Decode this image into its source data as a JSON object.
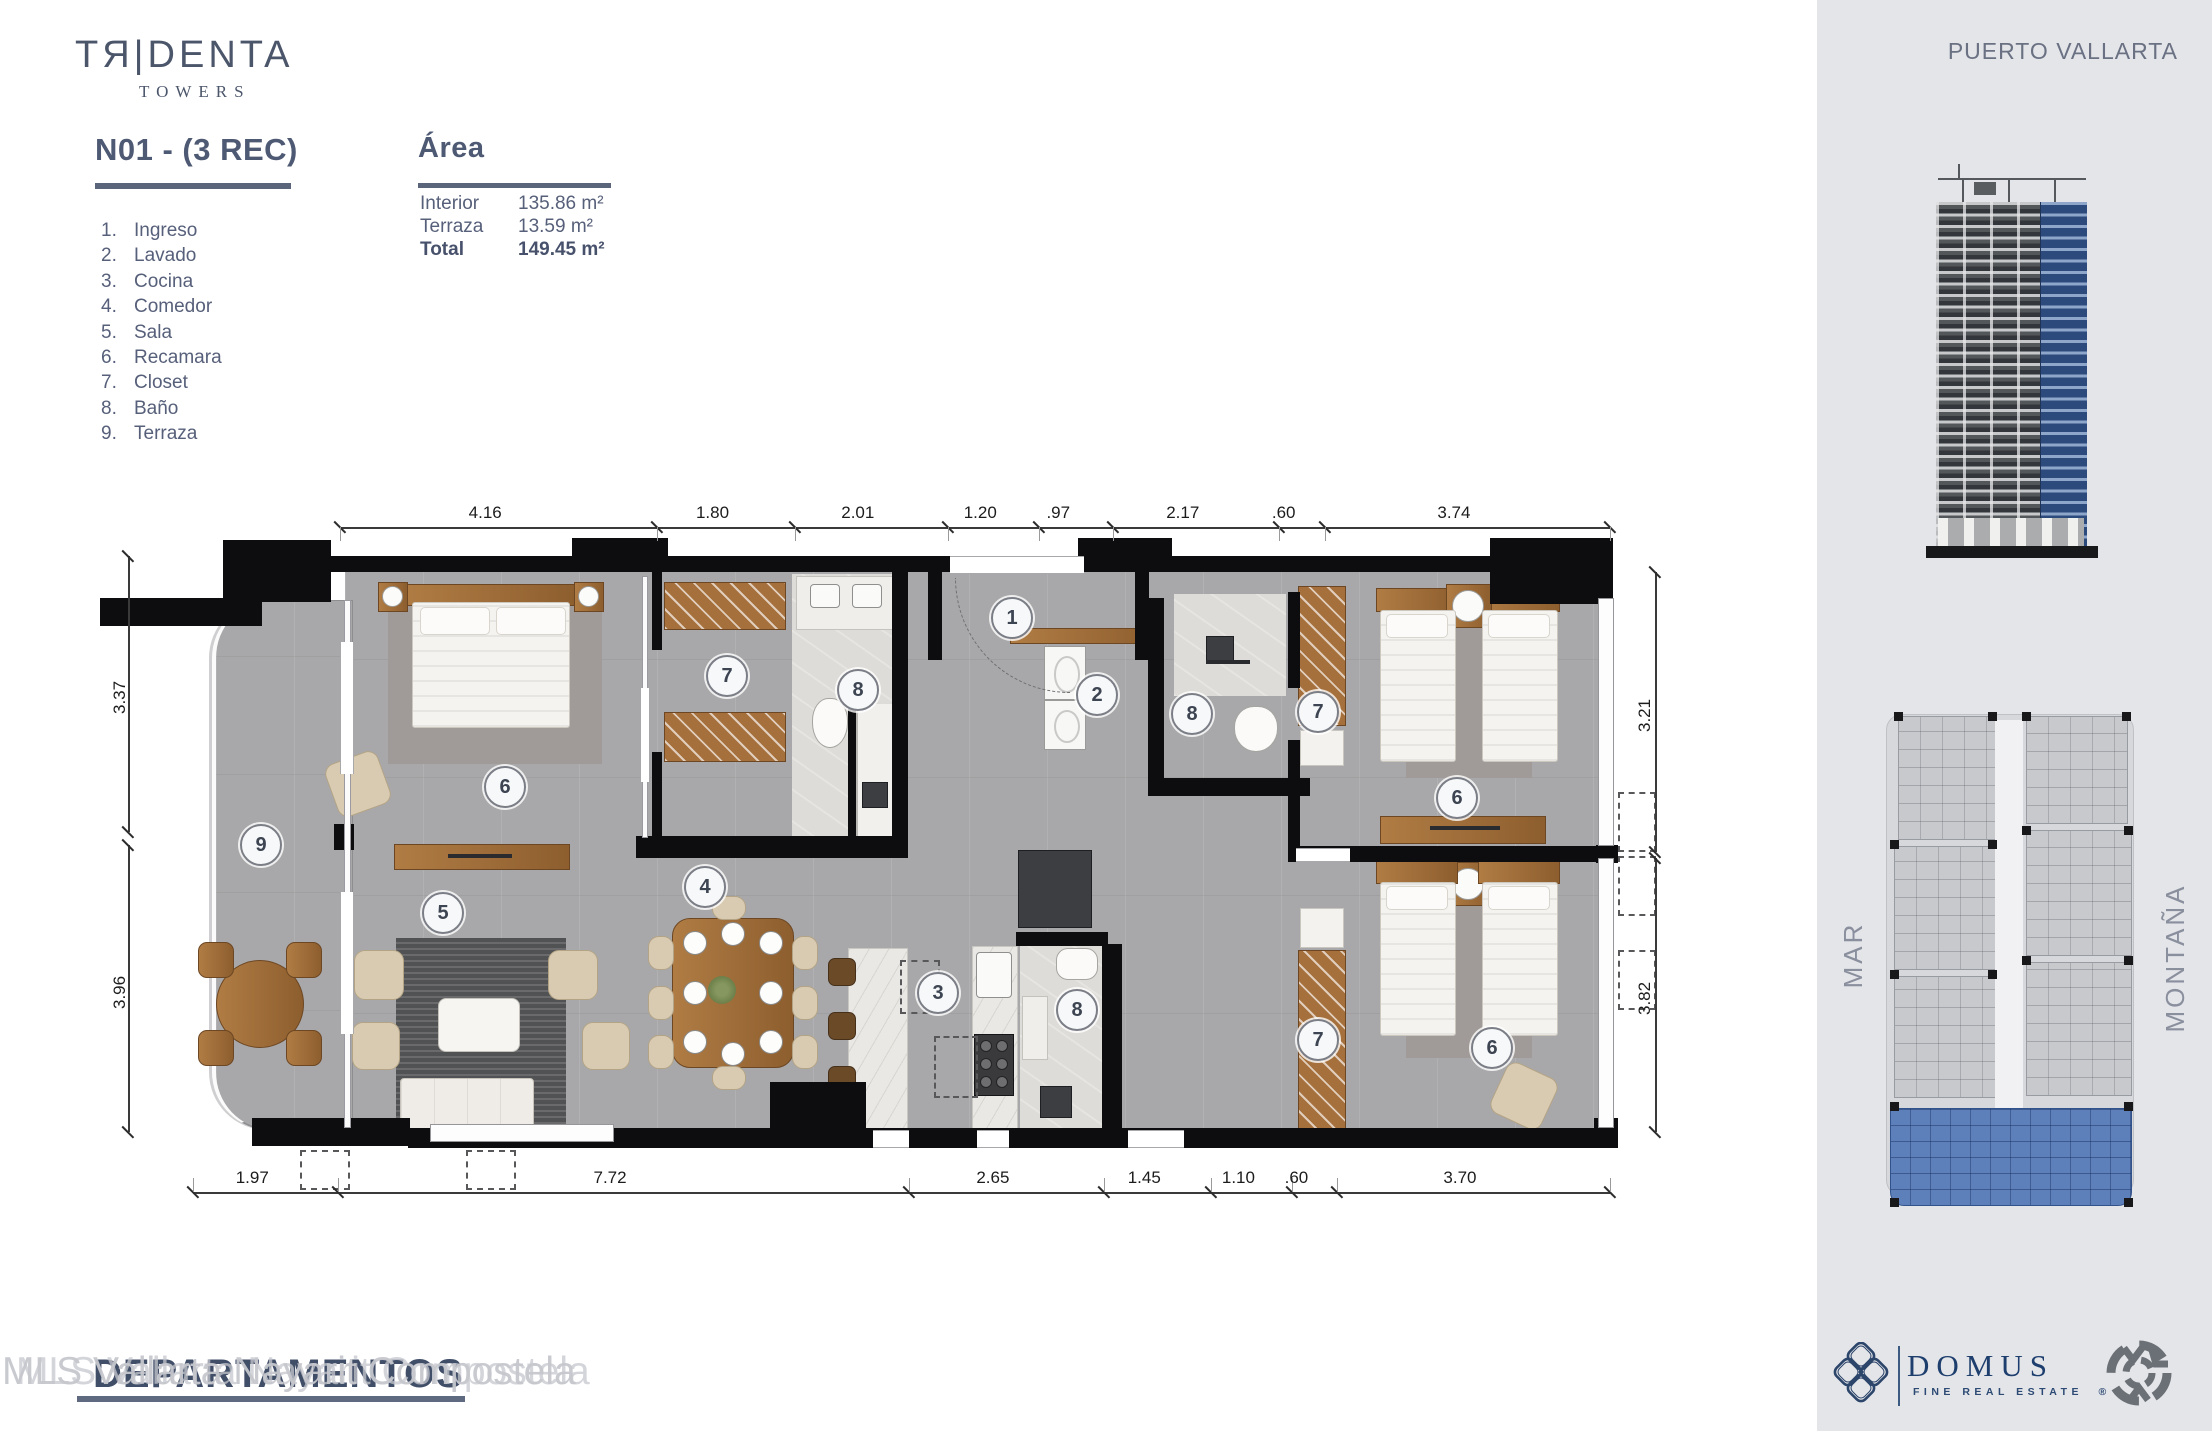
{
  "brand": {
    "logo_main": "TЯ|DENTA",
    "logo_sub": "TOWERS"
  },
  "unit": {
    "title": "N01 - (3 REC)"
  },
  "legend": {
    "items": [
      {
        "n": "1.",
        "label": "Ingreso"
      },
      {
        "n": "2.",
        "label": "Lavado"
      },
      {
        "n": "3.",
        "label": "Cocina"
      },
      {
        "n": "4.",
        "label": "Comedor"
      },
      {
        "n": "5.",
        "label": "Sala"
      },
      {
        "n": "6.",
        "label": "Recamara"
      },
      {
        "n": "7.",
        "label": "Closet"
      },
      {
        "n": "8.",
        "label": "Baño"
      },
      {
        "n": "9.",
        "label": "Terraza"
      }
    ]
  },
  "area": {
    "title": "Área",
    "rows": [
      {
        "label": "Interior",
        "value": "135.86 m²",
        "bold": false
      },
      {
        "label": "Terraza",
        "value": "13.59 m²",
        "bold": false
      },
      {
        "label": "Total",
        "value": "149.45 m²",
        "bold": true
      }
    ]
  },
  "floorplan": {
    "badges": [
      {
        "n": "9",
        "x": 261,
        "y": 845
      },
      {
        "n": "6",
        "x": 505,
        "y": 787
      },
      {
        "n": "5",
        "x": 443,
        "y": 913
      },
      {
        "n": "4",
        "x": 705,
        "y": 887
      },
      {
        "n": "7",
        "x": 727,
        "y": 676
      },
      {
        "n": "8",
        "x": 858,
        "y": 690
      },
      {
        "n": "1",
        "x": 1012,
        "y": 618
      },
      {
        "n": "2",
        "x": 1097,
        "y": 695
      },
      {
        "n": "8",
        "x": 1192,
        "y": 714
      },
      {
        "n": "7",
        "x": 1318,
        "y": 712
      },
      {
        "n": "6",
        "x": 1457,
        "y": 798
      },
      {
        "n": "3",
        "x": 938,
        "y": 993
      },
      {
        "n": "8",
        "x": 1077,
        "y": 1010
      },
      {
        "n": "7",
        "x": 1318,
        "y": 1040
      },
      {
        "n": "6",
        "x": 1492,
        "y": 1048
      }
    ],
    "dims": {
      "top": {
        "y": 527,
        "x1": 340,
        "x2": 1610,
        "labels": [
          "4.16",
          "1.80",
          "2.01",
          "1.20",
          ".97",
          "2.17",
          ".60",
          "3.74"
        ],
        "meters": [
          4.16,
          1.8,
          2.01,
          1.2,
          0.97,
          2.17,
          0.6,
          3.74
        ]
      },
      "bottom": {
        "y": 1192,
        "x1": 193,
        "x2": 1610,
        "labels": [
          "1.97",
          "7.72",
          "2.65",
          "1.45",
          "1.10",
          ".60",
          "3.70"
        ],
        "meters": [
          1.97,
          7.72,
          2.65,
          1.45,
          1.1,
          0.6,
          3.7
        ]
      },
      "left": {
        "x": 128,
        "segs": [
          {
            "label": "3.37",
            "y1": 556,
            "y2": 832
          },
          {
            "label": "3.96",
            "y1": 845,
            "y2": 1132
          }
        ]
      },
      "right": {
        "x": 1655,
        "segs": [
          {
            "label": "3.21",
            "y1": 572,
            "y2": 852
          },
          {
            "label": "3.82",
            "y1": 858,
            "y2": 1132
          }
        ]
      }
    }
  },
  "sidebar": {
    "location": "PUERTO VALLARTA",
    "compass": {
      "left": "MAR",
      "right": "MONTAÑA"
    },
    "domus": {
      "name": "DOMUS",
      "tagline": "FINE REAL ESTATE",
      "registered": "®"
    }
  },
  "watermark": {
    "light": "MLS Vallarta Nayarit Compostela",
    "bold": "DEPARTAMENTOS"
  }
}
